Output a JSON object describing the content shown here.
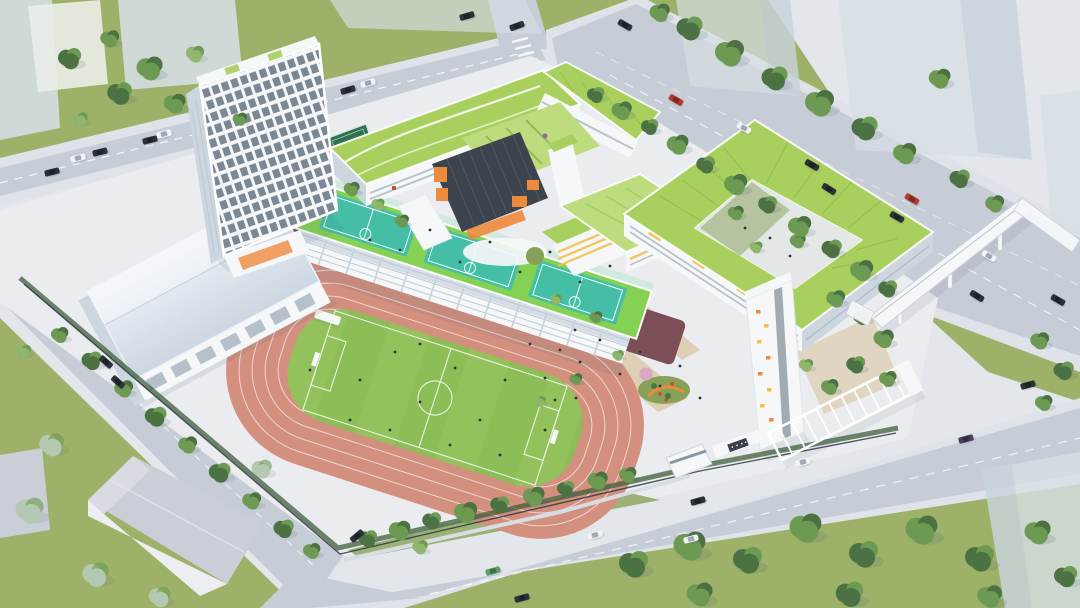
{
  "scene": {
    "type": "aerial-architectural-rendering",
    "subject": "bird's-eye view of a school campus with running track, rooftop sports courts, green-roofed teaching buildings, gymnasium, high-rise tower, entrance plaza, footbridge and surrounding roads with cars and trees",
    "objects": [
      "dormitory-tower",
      "gymnasium",
      "running-track",
      "soccer-field",
      "grandstand-rooftop-courts",
      "teaching-wing-northwest",
      "teaching-wing-north",
      "dark-building-orange-accents",
      "courtyard-ring-building",
      "yellow-band-building",
      "stair-tower-colorful-windows",
      "entrance-gate",
      "pergola-colonnade",
      "flower-garden",
      "pedestrian-footbridge",
      "north-road",
      "east-road",
      "south-road",
      "west-road",
      "context-ghost-buildings",
      "warehouse",
      "trees",
      "cars",
      "people"
    ]
  },
  "colors": {
    "base": "#e3e6eb",
    "road": "#c7cdd7",
    "sidewalk": "#dfe3e9",
    "plaza": "#eaecef",
    "pathTan": "#d9c6a2",
    "grass": "#9db268",
    "grassDark": "#87a258",
    "field": "#8cbd57",
    "fieldStripe": "#9ac763",
    "fieldLine": "#f4f7ef",
    "track": "#d4907f",
    "trackLine": "#f3e3de",
    "trackDark": "#7c4e55",
    "deckGreen": "#85d153",
    "courtTeal": "#44bfa6",
    "courtDarkGreen": "#2f7050",
    "roofGreen": "#a9cf5e",
    "roofGreenLight": "#bedc7e",
    "roofRow": "#8db945",
    "white": "#f5f7f9",
    "facadeShade": "#ccd6df",
    "windowDark": "#5d6b79",
    "windowLight": "#aab7c2",
    "charcoal": "#3d444d",
    "orange": "#ee8a3c",
    "yellow": "#f0c14b",
    "redAccent": "#c8502e",
    "treeDark": "#4c7243",
    "treeMid": "#6d9a52",
    "treeLight": "#90b56c",
    "treeBlue": "#b5c8b2",
    "hedge": "#3f5f3c",
    "ghost": "#d6dfe4",
    "ghostShade": "#c2cdd5",
    "warehouseRoof": "#caced6",
    "carDark": "#2c3238",
    "carWhite": "#f1f3f5",
    "carRed": "#b23b30",
    "carGreen": "#5d9e6b",
    "carPurple": "#4a3f63",
    "pink": "#d9a8c4",
    "gymRoofTop": "#eff4f9",
    "gymRoofBottom": "#ccd7e1",
    "shadow": "rgba(70,90,115,0.28)"
  }
}
